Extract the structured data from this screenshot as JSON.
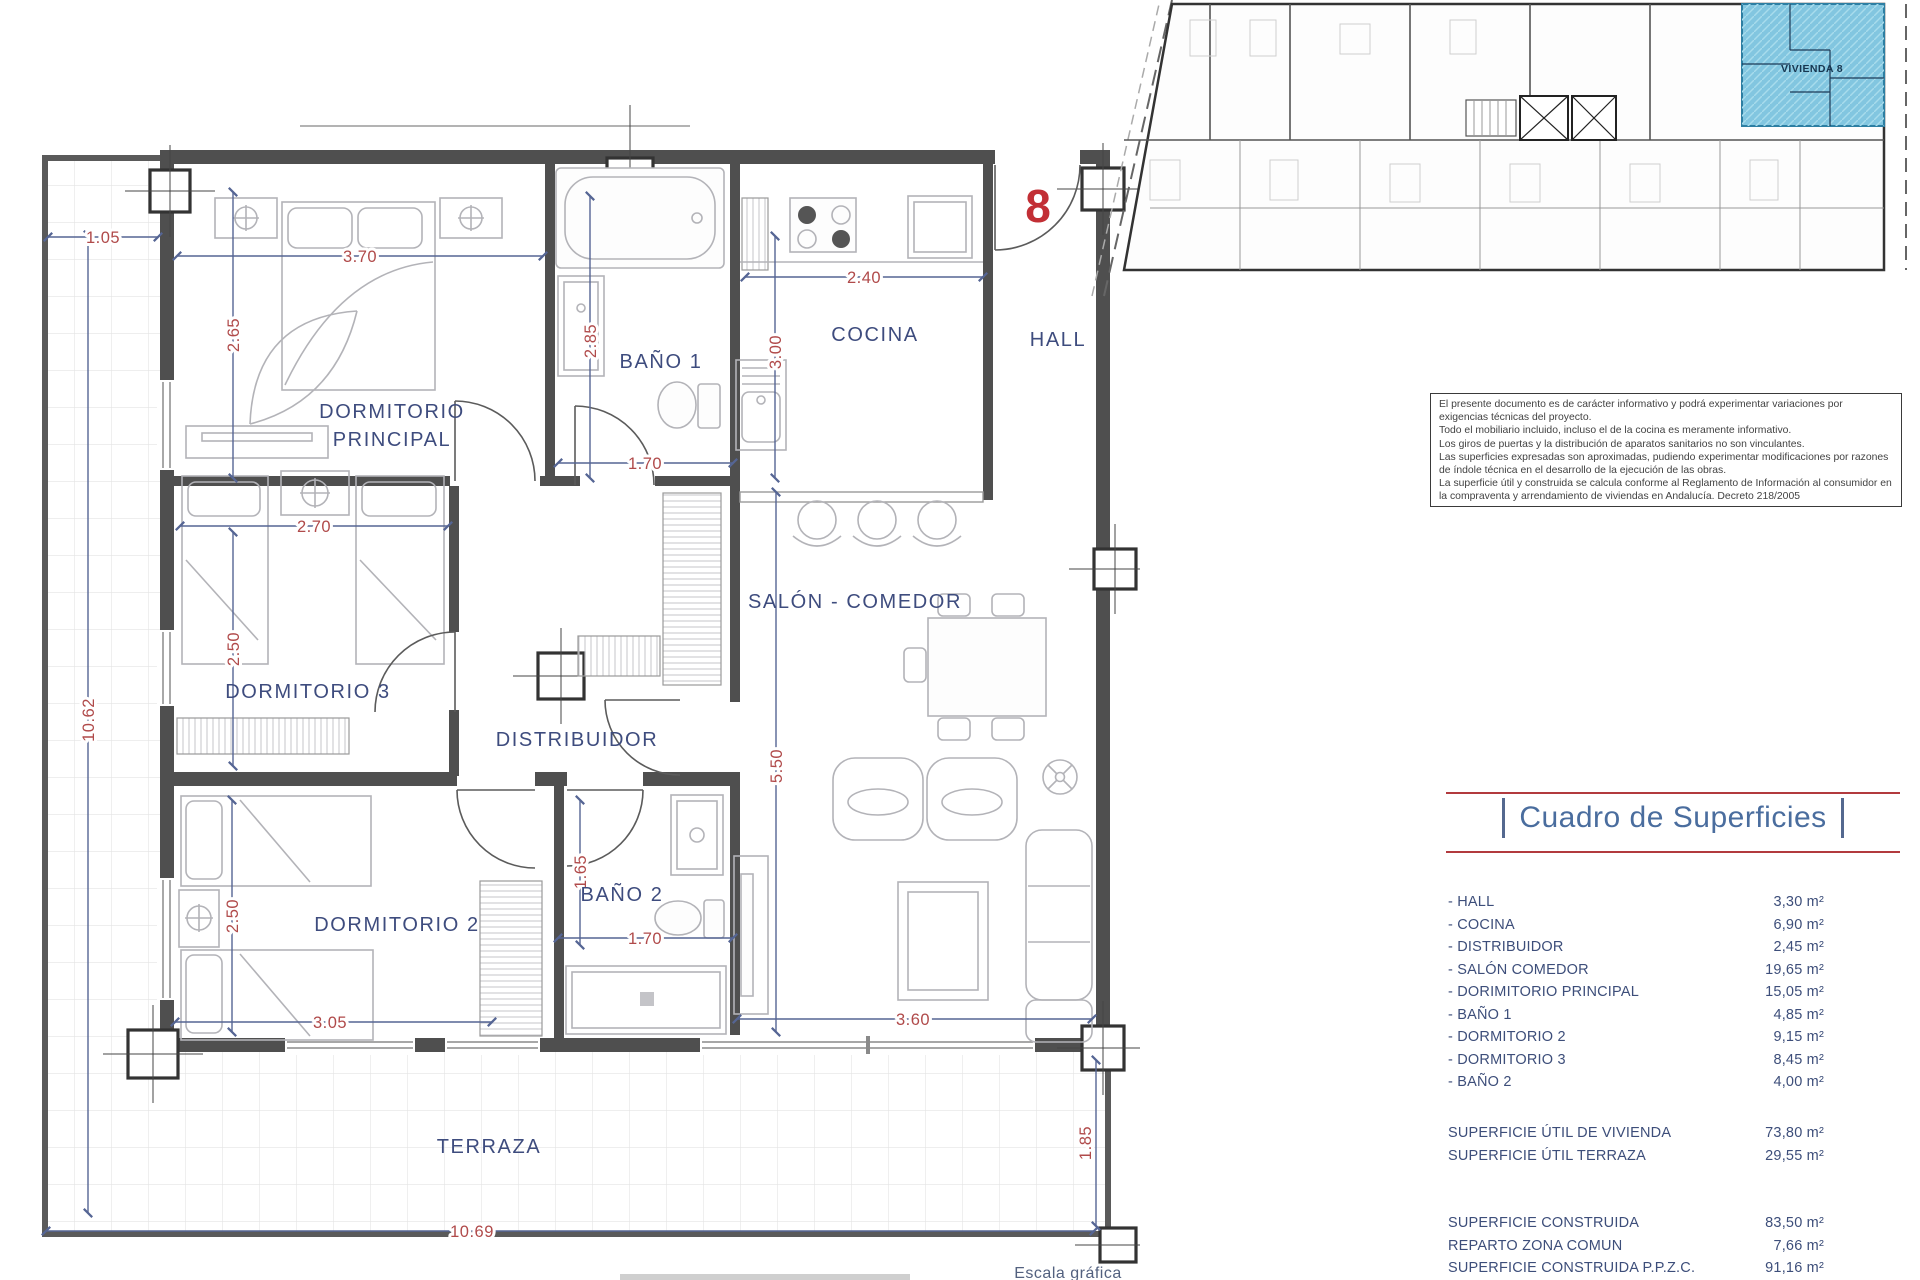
{
  "plan": {
    "unit_number": "8",
    "scale_label": "Escala gráfica",
    "rooms": {
      "dormitorio_principal_line1": "DORMITORIO",
      "dormitorio_principal_line2": "PRINCIPAL",
      "bano1": "BAÑO 1",
      "cocina": "COCINA",
      "hall": "HALL",
      "dormitorio3": "DORMITORIO 3",
      "distribuidor": "DISTRIBUIDOR",
      "salon": "SALÓN - COMEDOR",
      "dormitorio2": "DORMITORIO 2",
      "bano2": "BAÑO 2",
      "terraza": "TERRAZA"
    },
    "dimensions": {
      "terraza_side": "1.05",
      "dorm_ppal_w": "3.70",
      "dorm_ppal_h": "2.65",
      "bano1_h": "2.85",
      "cocina_w": "2.40",
      "cocina_h": "3.00",
      "bano1_w": "1.70",
      "dorm3_w": "2.70",
      "dorm3_h": "2.50",
      "total_h": "10.62",
      "salon_h": "5.50",
      "bano2_h": "1.65",
      "bano2_w": "1.70",
      "dorm2_h": "2.50",
      "dorm2_w": "3.05",
      "salon_w": "3.60",
      "terraza_s": "1.85",
      "terraza_w": "10.69"
    }
  },
  "keyplan": {
    "highlight_label": "VIVIENDA 8"
  },
  "disclaimer": {
    "lines": [
      "El presente documento es de carácter informativo y podrá experimentar variaciones por",
      "exigencias técnicas del proyecto.",
      "Todo el mobiliario incluido, incluso el de la cocina es meramente informativo.",
      "Los giros de puertas y la distribución de aparatos sanitarios no son vinculantes.",
      "Las superficies expresadas son aproximadas, pudiendo experimentar modificaciones por razones",
      "de índole técnica en el desarrollo de la ejecución de las obras.",
      "La superficie útil y construida se calcula conforme al Reglamento de Información al consumidor en",
      "la compraventa y arrendamiento de viviendas en Andalucía. Decreto 218/2005"
    ]
  },
  "superficies": {
    "title": "Cuadro de Superficies",
    "rooms": [
      {
        "label": "- HALL",
        "value": "3,30 m²"
      },
      {
        "label": "- COCINA",
        "value": "6,90 m²"
      },
      {
        "label": "- DISTRIBUIDOR",
        "value": "2,45 m²"
      },
      {
        "label": "- SALÓN COMEDOR",
        "value": "19,65 m²"
      },
      {
        "label": "- DORIMITORIO PRINCIPAL",
        "value": "15,05 m²"
      },
      {
        "label": "- BAÑO 1",
        "value": "4,85 m²"
      },
      {
        "label": "- DORMITORIO 2",
        "value": "9,15 m²"
      },
      {
        "label": "- DORMITORIO 3",
        "value": "8,45 m²"
      },
      {
        "label": "- BAÑO 2",
        "value": "4,00 m²"
      }
    ],
    "totals_util": [
      {
        "label": "SUPERFICIE ÚTIL DE VIVIENDA",
        "value": "73,80 m²"
      },
      {
        "label": "SUPERFICIE ÚTIL TERRAZA",
        "value": "29,55 m²"
      }
    ],
    "totals_construida": [
      {
        "label": "SUPERFICIE CONSTRUIDA",
        "value": "83,50 m²"
      },
      {
        "label": "REPARTO ZONA COMUN",
        "value": "7,66 m²"
      },
      {
        "label": "SUPERFICIE CONSTRUIDA P.P.Z.C.",
        "value": "91,16 m²"
      }
    ]
  },
  "colors": {
    "accent_red": "#b23a3e",
    "navy_label": "#3e4c7e",
    "dim_red": "#b04a4a",
    "dim_line_blue": "#556594",
    "title_blue": "#4a6d9e",
    "highlight_blue": "#7cc3de",
    "wall_gray": "#4f4f4f"
  }
}
